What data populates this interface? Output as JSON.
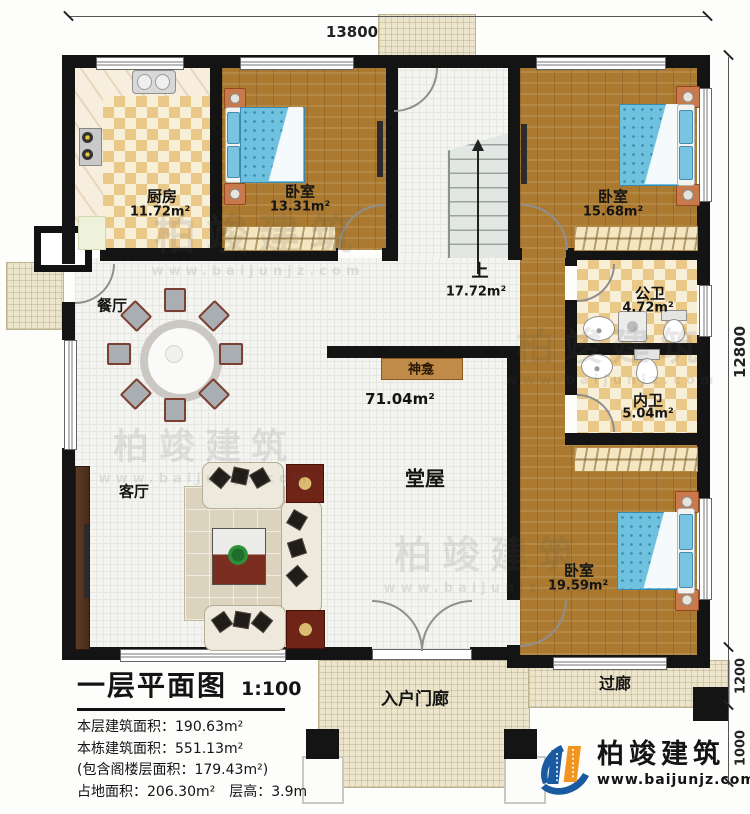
{
  "dimensions": {
    "width_total": "13800",
    "depth_total": "12800",
    "passage_depth": "1200",
    "step_depth": "1000"
  },
  "rooms": {
    "kitchen": {
      "name": "厨房",
      "area": "11.72m²"
    },
    "bedroom1": {
      "name": "卧室",
      "area": "13.31m²"
    },
    "stair": {
      "name": "上",
      "area": "17.72m²"
    },
    "bedroom2": {
      "name": "卧室",
      "area": "15.68m²"
    },
    "public_bath": {
      "name": "公卫",
      "area": "4.72m²"
    },
    "inner_bath": {
      "name": "内卫",
      "area": "5.04m²"
    },
    "bedroom3": {
      "name": "卧室",
      "area": "19.59m²"
    },
    "dining": {
      "name": "餐厅"
    },
    "living": {
      "name": "客厅"
    },
    "hall": {
      "name": "堂屋",
      "area": "71.04m²"
    },
    "shrine": {
      "name": "神龛"
    },
    "entry_porch": {
      "name": "入户门廊"
    },
    "passage": {
      "name": "过廊"
    }
  },
  "title_block": {
    "title": "一层平面图",
    "scale": "1:100",
    "lines": [
      "本层建筑面积：190.63m²",
      "本栋建筑面积：551.13m²",
      "(包含阁楼层面积：179.43m²)",
      "占地面积：206.30m²　层高：3.9m"
    ]
  },
  "branding": {
    "company": "柏竣建筑",
    "website": "www.baijunjz.com"
  },
  "watermark": {
    "text": "柏竣建筑",
    "sub": "www.baijunjz.com"
  },
  "colors": {
    "wall": "#141414",
    "wood_floor": "#ab7a30",
    "tile_checker": "#eac887",
    "bed_blue": "#6fc2df",
    "logo_blue": "#1a5aa0",
    "logo_orange": "#f29420"
  }
}
